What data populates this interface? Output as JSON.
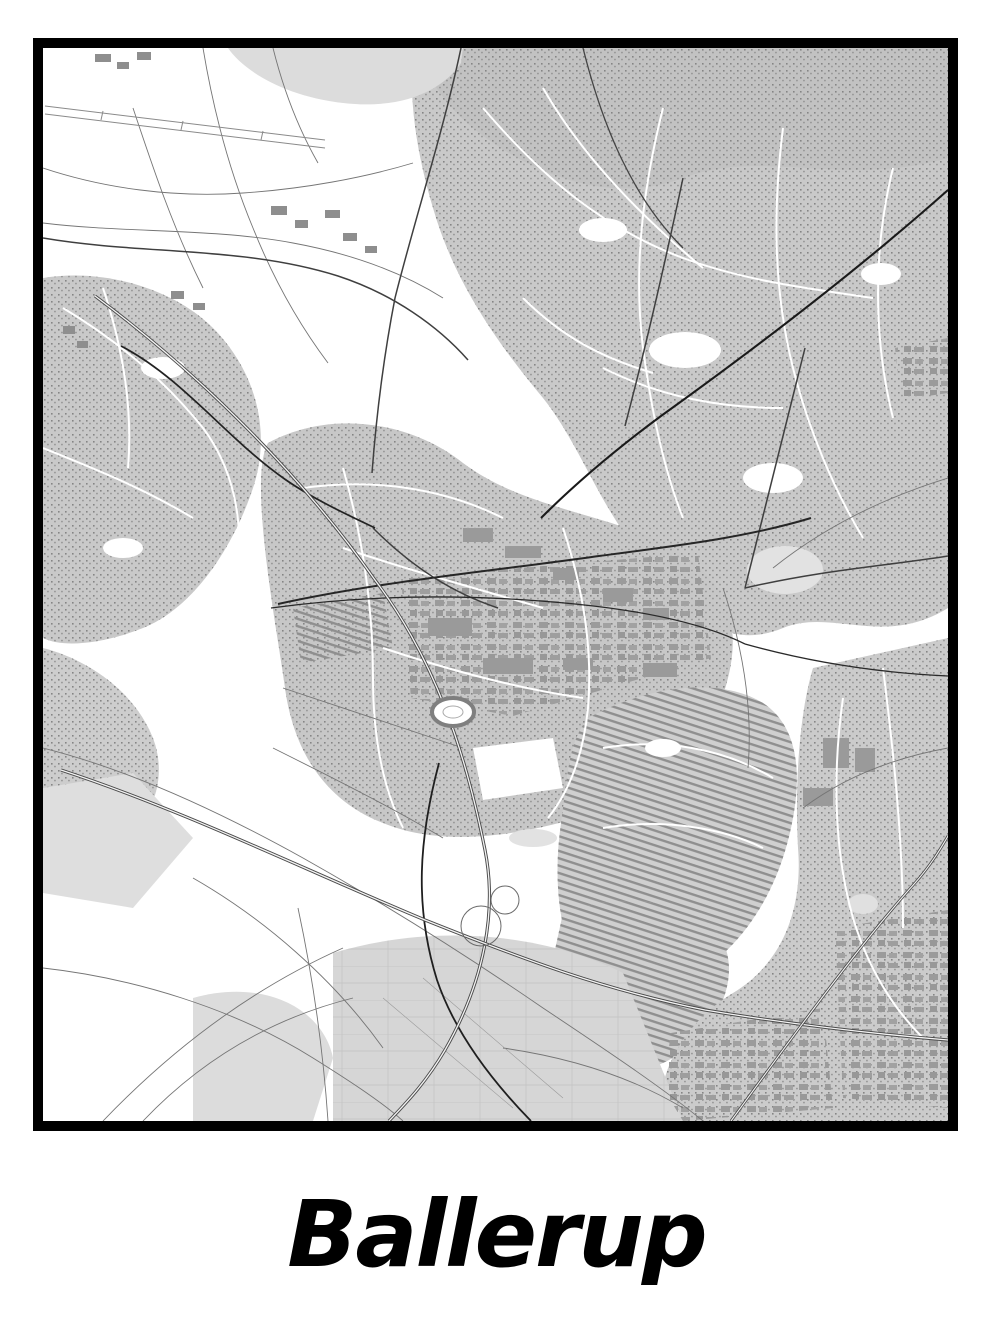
{
  "poster": {
    "title": "Ballerup",
    "colors": {
      "background": "#ffffff",
      "frame": "#000000",
      "title_text": "#000000",
      "map_land": "#ffffff",
      "map_urban_fill": "#c9c9c9",
      "map_forest_fill": "#c2c2c2",
      "map_water": "#dcdcdc",
      "map_buildings": "#9a9a9a",
      "map_road_minor": "#757575",
      "map_road_major": "#1a1a1a",
      "map_motorway_casing": "#4a4a4a",
      "map_motorway_core": "#f2f2f2"
    },
    "map_features": [
      "lake-top-left",
      "airfield-runway-top-left",
      "suburban-fabric-north-east",
      "town-center-ballerup",
      "industrial-blocks-center",
      "row-house-district-south-east",
      "motorway-interchange-south",
      "motorway-corridor",
      "railway-line",
      "stadium-oval",
      "rural-fields-south-west",
      "commercial-district-east"
    ]
  }
}
